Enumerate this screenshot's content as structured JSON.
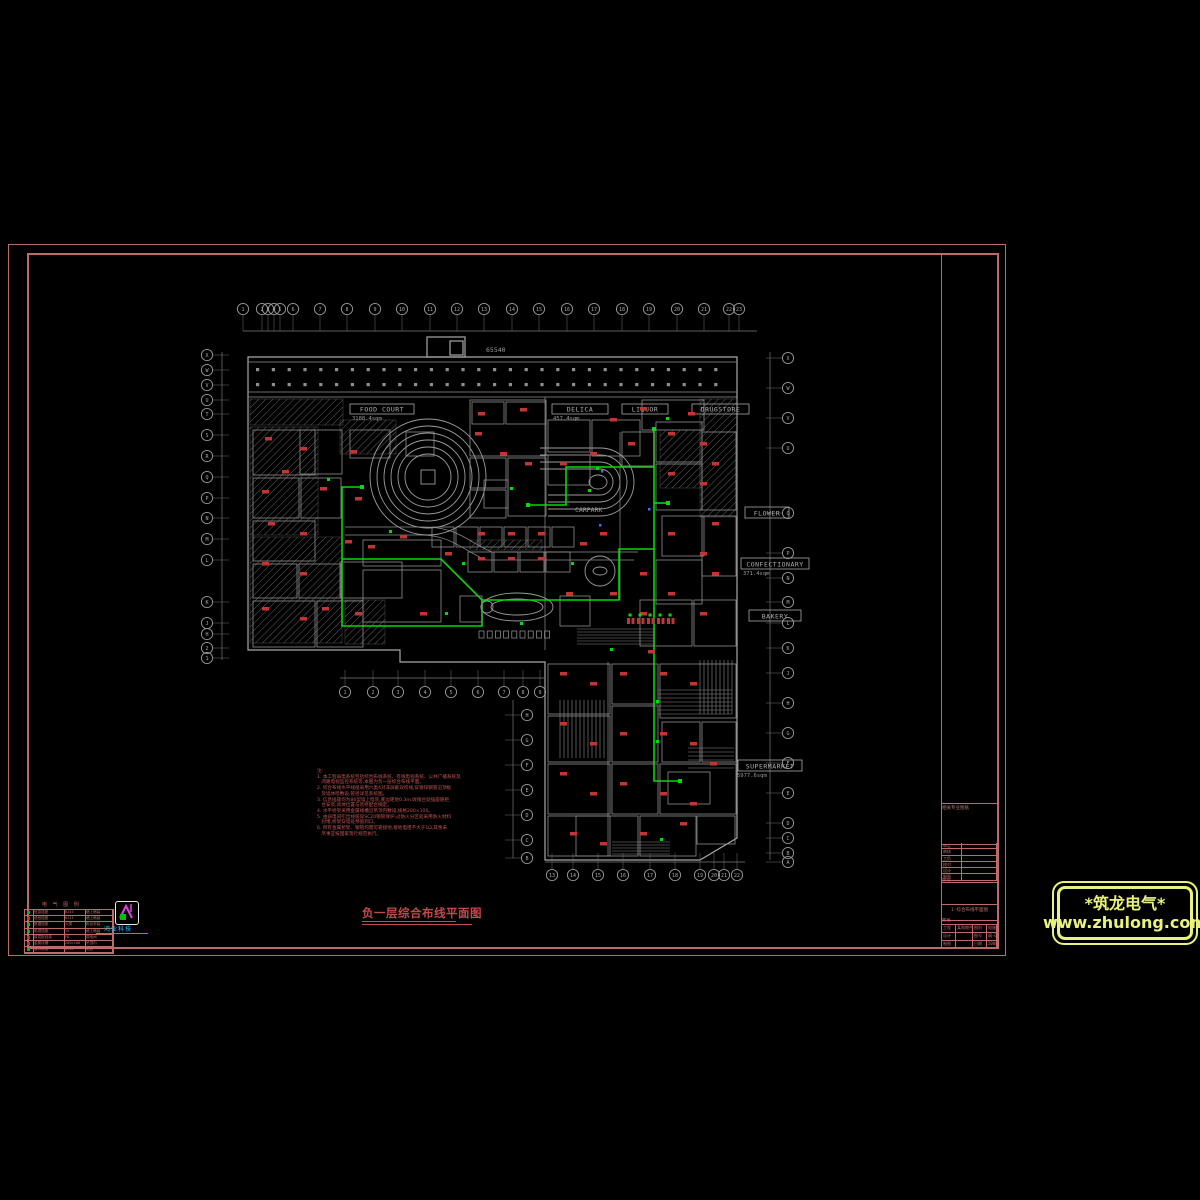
{
  "sheet": {
    "drawing_title": "负一层综合布线平面图",
    "frame_color": "#bc6a6a",
    "plan_color": "#9c9c9c",
    "wire_color": "#00dd00",
    "marker_color": "#c23535"
  },
  "stores": [
    {
      "name": "FOOD COURT",
      "area": "3188.4sqm",
      "x": 350,
      "y": 404,
      "w": 64,
      "h": 10,
      "ax": 352,
      "ay": 420
    },
    {
      "name": "DELICA",
      "area": "457.4sqm",
      "x": 552,
      "y": 404,
      "w": 56,
      "h": 10,
      "ax": 553,
      "ay": 420
    },
    {
      "name": "LIQUOR",
      "area": "",
      "x": 622,
      "y": 404,
      "w": 46,
      "h": 10,
      "ax": 0,
      "ay": 0
    },
    {
      "name": "DRUGSTORE",
      "area": "",
      "x": 692,
      "y": 404,
      "w": 57,
      "h": 10,
      "ax": 0,
      "ay": 0
    },
    {
      "name": "FLOWER",
      "area": "",
      "x": 745,
      "y": 507,
      "w": 44,
      "h": 11,
      "ax": 0,
      "ay": 0
    },
    {
      "name": "CONFECTIONARY",
      "area": "371.4sqm",
      "x": 741,
      "y": 558,
      "w": 68,
      "h": 11,
      "ax": 743,
      "ay": 575
    },
    {
      "name": "BAKERY",
      "area": "",
      "x": 749,
      "y": 610,
      "w": 52,
      "h": 11,
      "ax": 0,
      "ay": 0
    },
    {
      "name": "SUPERMARKET",
      "area": "5977.6sqm",
      "x": 738,
      "y": 760,
      "w": 64,
      "h": 11,
      "ax": 737,
      "ay": 777
    }
  ],
  "plan_texts": [
    {
      "t": "CARPARK",
      "x": 575,
      "y": 512
    },
    {
      "t": "65540",
      "x": 486,
      "y": 352
    }
  ],
  "grid": {
    "top": {
      "y": 309,
      "items": [
        [
          243,
          "1"
        ],
        [
          262,
          "2"
        ],
        [
          268,
          "3"
        ],
        [
          274,
          "4"
        ],
        [
          280,
          "5"
        ],
        [
          293,
          "6"
        ],
        [
          320,
          "7"
        ],
        [
          347,
          "8"
        ],
        [
          375,
          "9"
        ],
        [
          402,
          "10"
        ],
        [
          430,
          "11"
        ],
        [
          457,
          "12"
        ],
        [
          484,
          "13"
        ],
        [
          512,
          "14"
        ],
        [
          539,
          "15"
        ],
        [
          567,
          "16"
        ],
        [
          594,
          "17"
        ],
        [
          622,
          "18"
        ],
        [
          649,
          "19"
        ],
        [
          677,
          "20"
        ],
        [
          704,
          "21"
        ],
        [
          729,
          "22"
        ],
        [
          739,
          "23"
        ]
      ]
    },
    "left": {
      "x": 207,
      "items": [
        [
          355,
          "X"
        ],
        [
          370,
          "W"
        ],
        [
          385,
          "V"
        ],
        [
          400,
          "U"
        ],
        [
          414,
          "T"
        ],
        [
          435,
          "S"
        ],
        [
          456,
          "R"
        ],
        [
          477,
          "Q"
        ],
        [
          498,
          "P"
        ],
        [
          518,
          "N"
        ],
        [
          539,
          "M"
        ],
        [
          560,
          "L"
        ],
        [
          602,
          "K"
        ],
        [
          623,
          "J"
        ],
        [
          634,
          "H"
        ],
        [
          648,
          "2"
        ],
        [
          658,
          "1"
        ]
      ]
    },
    "right": {
      "x": 788,
      "items": [
        [
          358,
          "X"
        ],
        [
          388,
          "W"
        ],
        [
          418,
          "V"
        ],
        [
          448,
          "U"
        ],
        [
          513,
          "Q"
        ],
        [
          553,
          "P"
        ],
        [
          578,
          "N"
        ],
        [
          602,
          "M"
        ],
        [
          623,
          "L"
        ],
        [
          648,
          "K"
        ],
        [
          673,
          "J"
        ],
        [
          703,
          "H"
        ],
        [
          733,
          "G"
        ],
        [
          763,
          "F"
        ],
        [
          793,
          "E"
        ],
        [
          823,
          "D"
        ],
        [
          838,
          "C"
        ],
        [
          853,
          "B"
        ],
        [
          862,
          "A"
        ]
      ]
    },
    "bottom_left": {
      "y": 692,
      "items": [
        [
          345,
          "1"
        ],
        [
          373,
          "2"
        ],
        [
          398,
          "3"
        ],
        [
          425,
          "4"
        ],
        [
          451,
          "5"
        ],
        [
          478,
          "6"
        ],
        [
          504,
          "7"
        ],
        [
          523,
          "8"
        ],
        [
          540,
          "9"
        ]
      ]
    },
    "bottom_right": {
      "y": 875,
      "items": [
        [
          552,
          "13"
        ],
        [
          573,
          "14"
        ],
        [
          598,
          "15"
        ],
        [
          623,
          "16"
        ],
        [
          650,
          "17"
        ],
        [
          675,
          "18"
        ],
        [
          700,
          "19"
        ],
        [
          714,
          "20"
        ],
        [
          724,
          "21"
        ],
        [
          737,
          "22"
        ]
      ]
    },
    "mid_col": {
      "x": 527,
      "items": [
        [
          715,
          "H"
        ],
        [
          740,
          "G"
        ],
        [
          765,
          "F"
        ],
        [
          790,
          "E"
        ],
        [
          815,
          "D"
        ],
        [
          840,
          "C"
        ],
        [
          858,
          "B"
        ]
      ]
    }
  },
  "notes": {
    "lines": [
      "注:",
      "1. 本工程弱电系统包括综合布线系统、有线电视系统、公共广播系统及",
      "   闭路电视监控系统等,本图为负一层综合布线平面。",
      "2. 综合布线水平线缆采用六类4对非屏蔽双绞线,穿镀锌钢管沿顶板",
      "   及墙体暗敷设,管径详见系统图。",
      "3. 信息插座均为86型墙上暗装,底边距地0.3m,收银台处插座随柜",
      "   台安装,具体位置与装修配合确定。",
      "4. 水平桥架采用金属线槽沿吊顶内敷设,规格200×100。",
      "5. 由弱电间引出线缆穿SC20钢管保护,过防火分区处采用防火材料",
      "   封堵,桥架穿墙处预留洞口。",
      "6. 所有金属桥架、钢管均需可靠接地,接地电阻不大于1Ω,其余未",
      "   尽事宜按国家现行规范执行。"
    ]
  },
  "legend": {
    "title": "电 气 图 例",
    "rows": [
      {
        "c": "#00c000",
        "t": "信息插座",
        "m": "RJ45",
        "i": "墙上暗装"
      },
      {
        "c": "#c03030",
        "t": "语音插座",
        "m": "RJ11",
        "i": "墙上暗装"
      },
      {
        "c": "#00c000",
        "t": "数据插座",
        "m": "六类",
        "i": "柜台安装"
      },
      {
        "c": "#00c000",
        "t": "电视插座",
        "m": "TV",
        "i": "墙上暗装"
      },
      {
        "c": "#c03030",
        "t": "楼层配线架",
        "m": "FD",
        "i": "弱电间"
      },
      {
        "c": "#c03030",
        "t": "金属线槽",
        "m": "200×100",
        "i": "吊顶内"
      },
      {
        "c": "#00c000",
        "t": "镀锌钢管",
        "m": "SC20",
        "i": "暗敷"
      }
    ]
  },
  "vendor": {
    "text": "鸿业科技"
  },
  "title_block": {
    "section_label": "相关专业图纸",
    "sign_rows": [
      [
        "审定",
        ""
      ],
      [
        "审核",
        ""
      ],
      [
        "工负",
        ""
      ],
      [
        "校对",
        ""
      ],
      [
        "设计",
        ""
      ],
      [
        "制图",
        ""
      ]
    ],
    "stage_label": "会签",
    "name_label": "图名",
    "dwg_name": "1-综合布线平面图",
    "bottom_rows": [
      [
        "工程",
        "某购物中心",
        "图别",
        "电施"
      ],
      [
        "设计",
        "",
        "图号",
        "弱-01"
      ],
      [
        "制图",
        "",
        "日期",
        "2008.6"
      ]
    ]
  },
  "logo": {
    "line1": "*筑龙电气*",
    "line2": "www.zhulong.com"
  }
}
